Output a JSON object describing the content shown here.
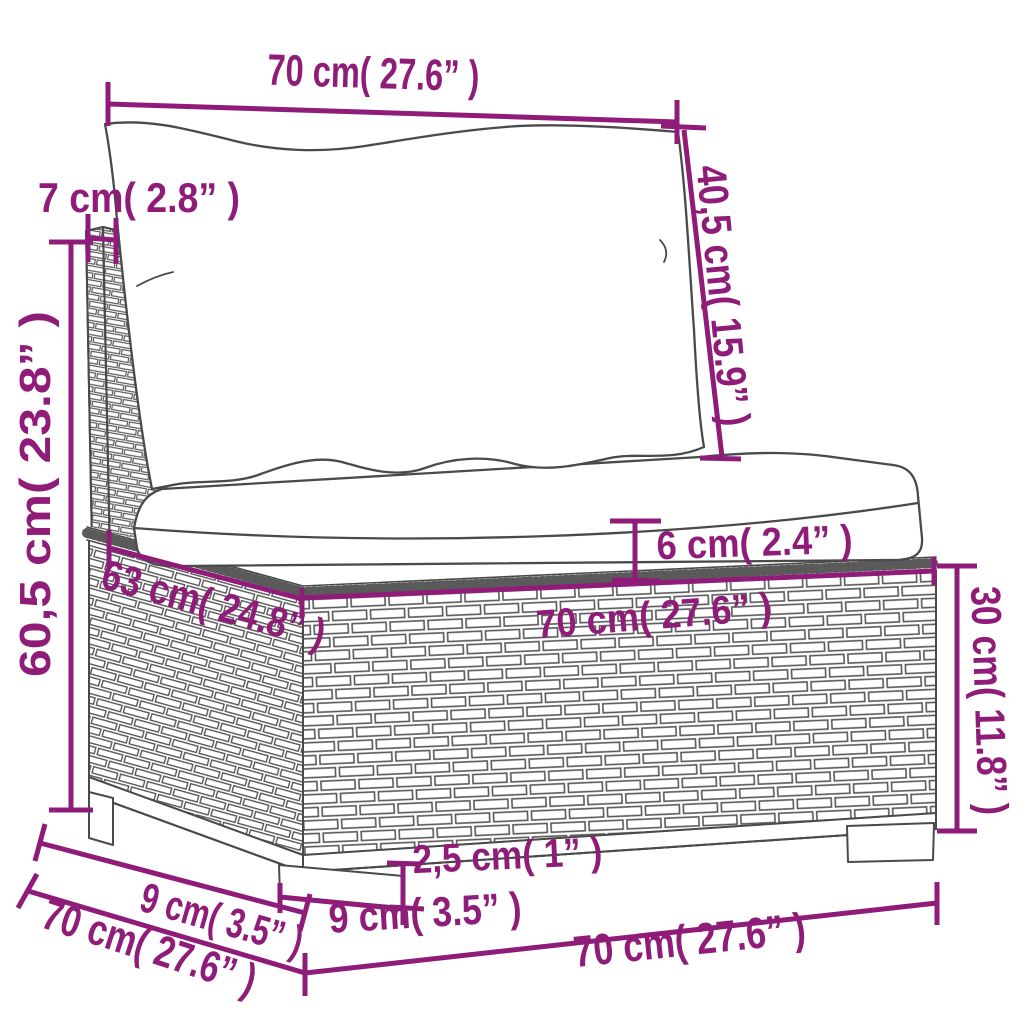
{
  "colors": {
    "dimension": "#8e1c78",
    "outline": "#4a4a4a",
    "background": "#ffffff"
  },
  "dimensions": {
    "back_width": {
      "label": "70 cm( 27.6” )"
    },
    "back_panel_thickness": {
      "label": "7 cm( 2.8” )"
    },
    "back_cushion_height": {
      "label": "40,5 cm( 15.9” )"
    },
    "total_height": {
      "label": "60,5 cm( 23.8” )"
    },
    "seat_cushion_thickness": {
      "label": "6 cm( 2.4” )"
    },
    "seat_depth": {
      "label": "63 cm( 24.8” )"
    },
    "seat_width": {
      "label": "70 cm( 27.6” )"
    },
    "base_height": {
      "label": "30 cm( 11.8” )"
    },
    "leg_inset_depth": {
      "label": "9 cm( 3.5” )"
    },
    "total_depth": {
      "label": "70 cm( 27.6” )"
    },
    "leg_height": {
      "label": "2,5 cm( 1” )"
    },
    "leg_width": {
      "label": "9 cm( 3.5” )"
    },
    "total_width": {
      "label": "70 cm( 27.6” )"
    }
  }
}
